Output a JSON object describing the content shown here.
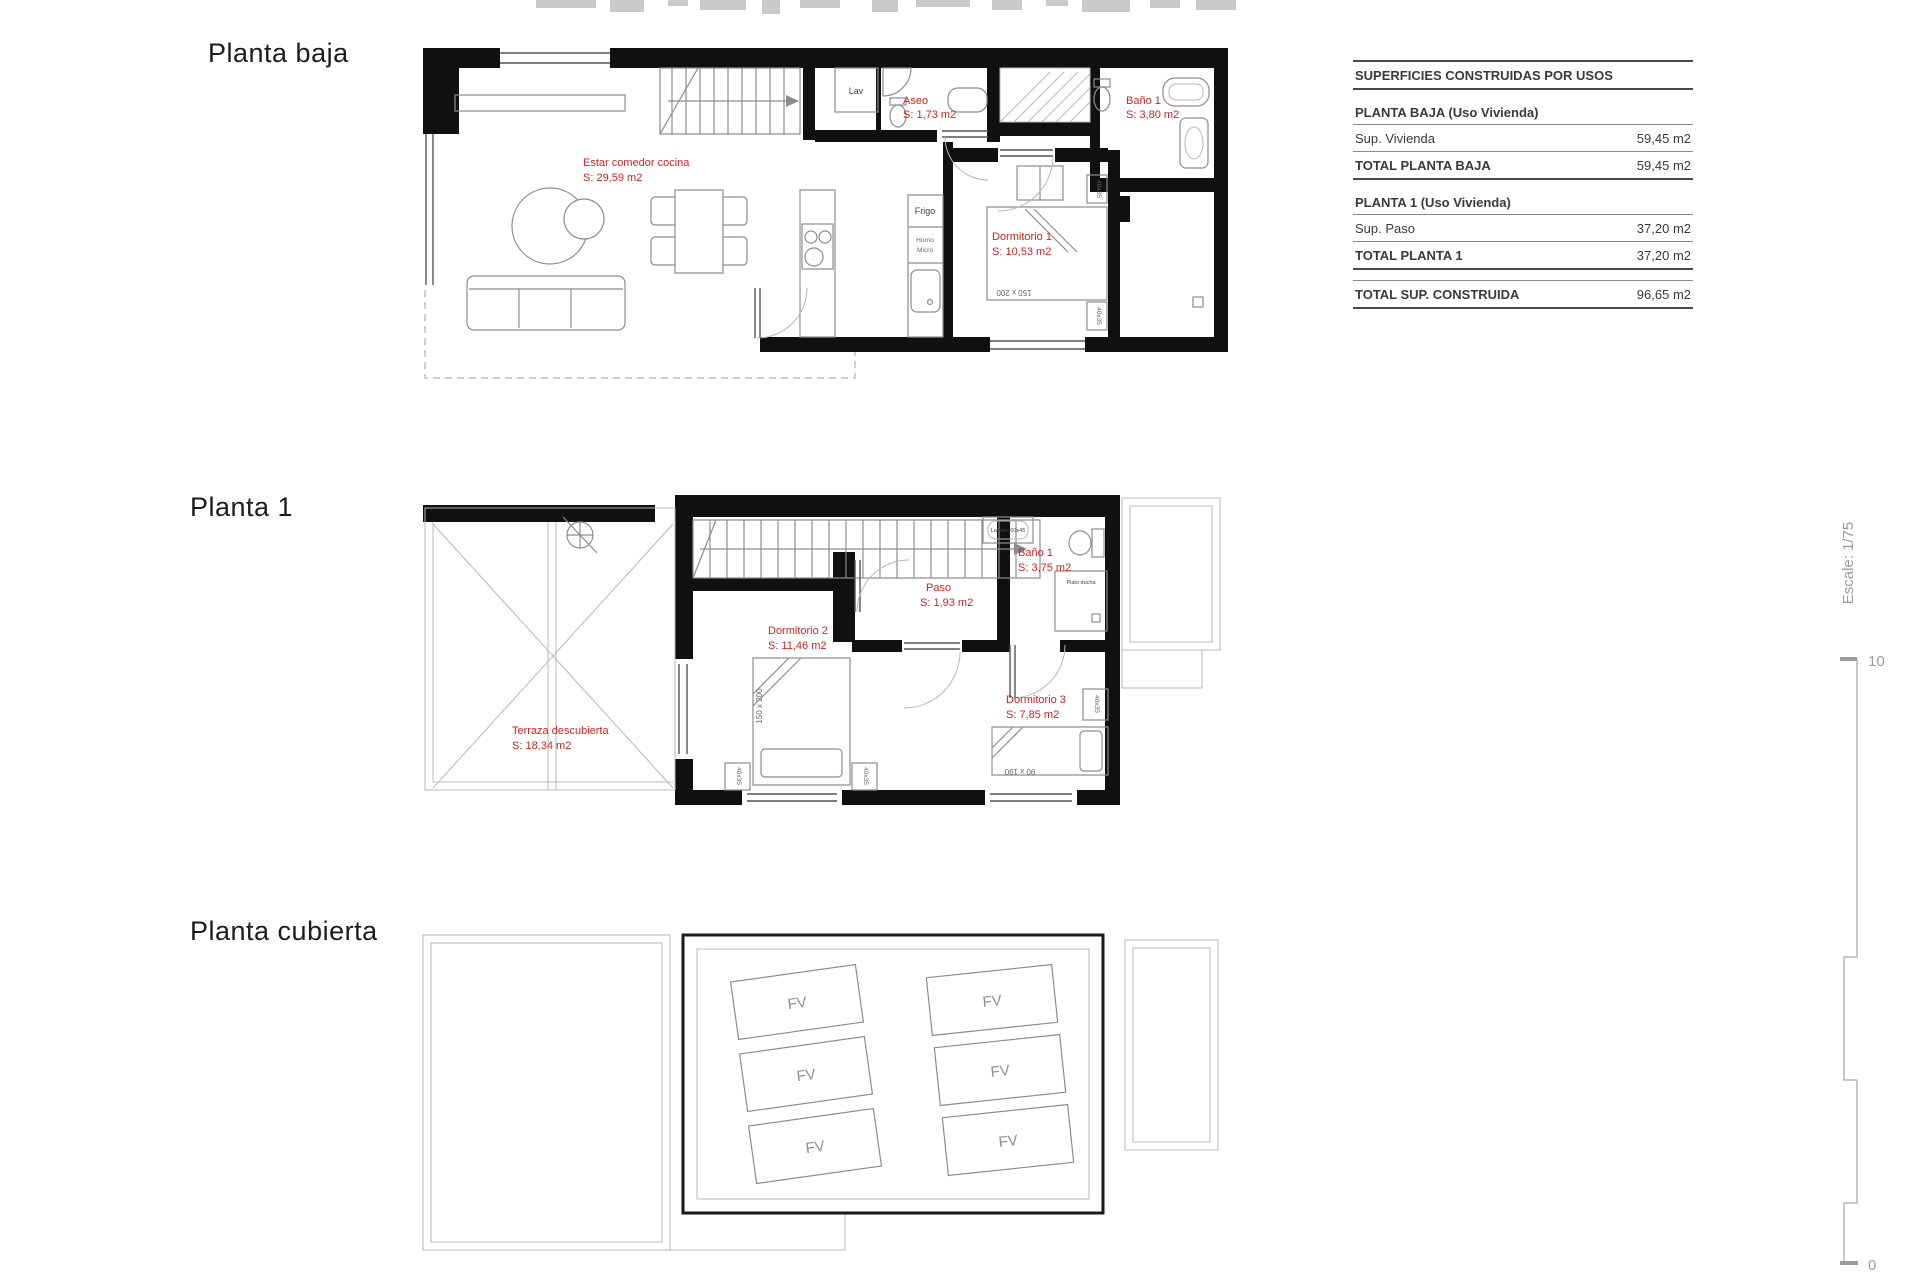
{
  "titles": {
    "planta_baja": "Planta baja",
    "planta_1": "Planta 1",
    "planta_cubierta": "Planta cubierta"
  },
  "areas_table": {
    "header": "SUPERFICIES CONSTRUIDAS POR USOS",
    "pb_title": "PLANTA BAJA (Uso Vivienda)",
    "pb_row_label": "Sup. Vivienda",
    "pb_row_value": "59,45 m2",
    "pb_total_label": "TOTAL PLANTA BAJA",
    "pb_total_value": "59,45 m2",
    "p1_title": "PLANTA 1 (Uso Vivienda)",
    "p1_row_label": "Sup. Paso",
    "p1_row_value": "37,20 m2",
    "p1_total_label": "TOTAL PLANTA 1",
    "p1_total_value": "37,20 m2",
    "grand_total_label": "TOTAL SUP. CONSTRUIDA",
    "grand_total_value": "96,65 m2"
  },
  "planta_baja": {
    "estar_name": "Estar comedor cocina",
    "estar_area": "S: 29,59 m2",
    "aseo_name": "Aseo",
    "aseo_area": "S: 1,73 m2",
    "bano_name": "Baño 1",
    "bano_area": "S: 3,80 m2",
    "dorm1_name": "Dormitorio 1",
    "dorm1_area": "S: 10,53 m2",
    "lav": "Lav",
    "frigo": "Frigo",
    "horno": "Horno",
    "micro": "Micro",
    "bed_size": "150 x 200",
    "nightstand_size": "40x35"
  },
  "planta_1": {
    "terraza_name": "Terraza descubierta",
    "terraza_area": "S: 18,34 m2",
    "dorm2_name": "Dormitorio 2",
    "dorm2_area": "S: 11,46 m2",
    "paso_name": "Paso",
    "paso_area": "S: 1,93 m2",
    "bano_name": "Baño 1",
    "bano_area": "S: 3,75 m2",
    "dorm3_name": "Dormitorio 3",
    "dorm3_area": "S: 7,85 m2",
    "bed2_size": "150 x 200",
    "bed3_size": "90 x 190",
    "nightstand_size": "40x35",
    "lavabo_label": "Lavabo 60x45",
    "ducha_label": "Plato ducha"
  },
  "planta_cubierta": {
    "panel_label": "FV"
  },
  "scale_bar": {
    "label": "Escale: 1/75",
    "top_value": "10",
    "bottom_value": "0"
  },
  "colors": {
    "label_red": "#cc2424",
    "wall": "#101010",
    "furniture_gray": "#8d8d8d",
    "scale_gray": "#9c9c9c"
  }
}
